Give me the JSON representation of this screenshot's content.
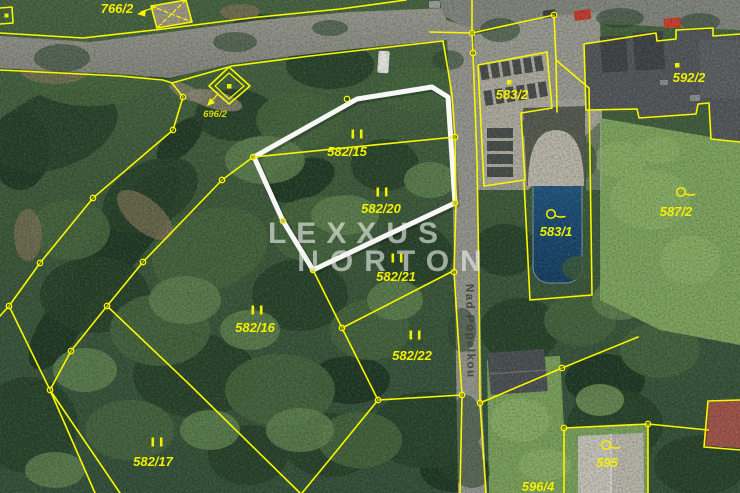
{
  "map": {
    "watermark": {
      "line1": "LEXXUS",
      "line2": "NORTON"
    },
    "street": {
      "name": "Nad Popelkou"
    },
    "parcels": [
      {
        "label": "766/2",
        "type": "building-with-arrow"
      },
      {
        "label": "696/2",
        "type": "plain"
      },
      {
        "label": "582/15",
        "type": "forest"
      },
      {
        "label": "582/20",
        "type": "forest"
      },
      {
        "label": "582/21",
        "type": "forest"
      },
      {
        "label": "582/16",
        "type": "forest"
      },
      {
        "label": "582/22",
        "type": "forest"
      },
      {
        "label": "582/17",
        "type": "forest"
      },
      {
        "label": "583/2",
        "type": "building-dot"
      },
      {
        "label": "583/1",
        "type": "garden"
      },
      {
        "label": "592/2",
        "type": "building-dot"
      },
      {
        "label": "587/2",
        "type": "garden"
      },
      {
        "label": "595",
        "type": "garden"
      },
      {
        "label": "596/4",
        "type": "plain"
      }
    ],
    "highlight": {
      "parcels": [
        "582/15",
        "582/20"
      ],
      "outline_color": "#ffffff"
    },
    "colors": {
      "boundary_line": "#f8f600",
      "label_text": "#f2ef00",
      "highlight_outline": "#ffffff",
      "watermark_text": "#f1f3f0",
      "pool_water": "#1c4a74",
      "forest_base": "#3d5a3c"
    }
  }
}
